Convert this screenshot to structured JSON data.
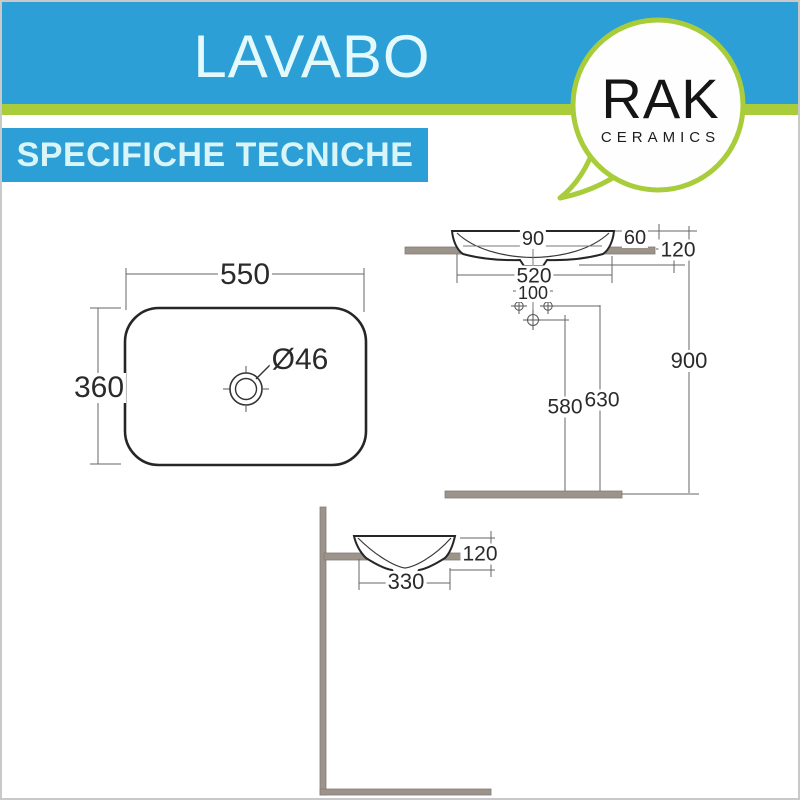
{
  "header": {
    "title": "LAVABO",
    "subtitle": "SPECIFICHE TECNICHE"
  },
  "brand": {
    "name": "RAK",
    "tagline": "CERAMICS"
  },
  "dims": {
    "plan": {
      "width": "550",
      "depth": "360",
      "drain": "Ø46"
    },
    "side": {
      "rim": "90",
      "overhang": "60",
      "height": "120",
      "width": "520",
      "hole_spacing": "100",
      "total_height": "900",
      "hole_front": "580",
      "hole_back": "630"
    },
    "front": {
      "height": "120",
      "width": "330"
    }
  },
  "colors": {
    "brand_blue": "#2b9fd6",
    "brand_green": "#a8cc3a",
    "header_text": "#e4f9fc",
    "counter_gray": "#9c938b",
    "line_dark": "#2b2b2b"
  }
}
